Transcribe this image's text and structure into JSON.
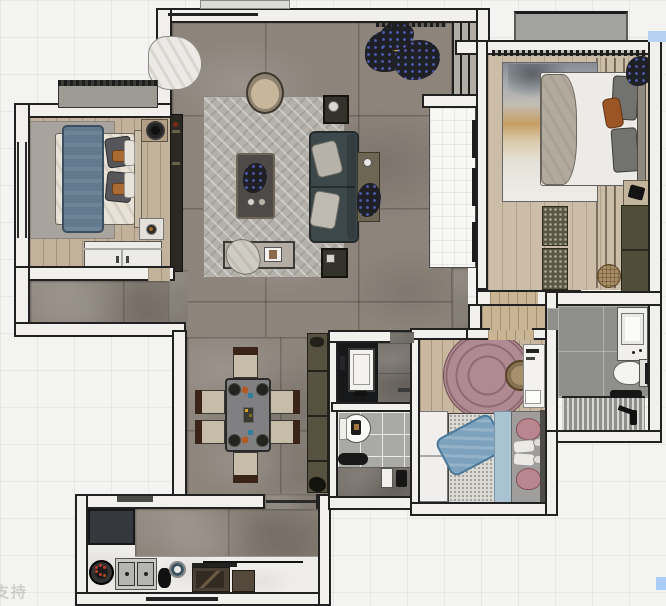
{
  "scene": {
    "type": "apartment-floor-plan-top-down-render",
    "style": "3d-rendered furnished floor plan on light grid background"
  },
  "watermarks": {
    "bottom_left_text": "支持",
    "top_right_swatch_color": "#b5d2f2",
    "bottom_right_swatch_color": "#a9cdf4"
  },
  "palette": {
    "background_grid": "#f3f3f2",
    "wall_fill": "#f1f0ed",
    "wall_outline": "#212121",
    "living_floor_marble": "#8d857c",
    "bedroom_wood": "#c3b29b",
    "master_wood": "#ccbda8",
    "kid_wood": "#c9b79f",
    "rug_grey_herringbone": "#b4b1ab",
    "rug_pink": "#b08a92",
    "sofa_teal": "#3d484b",
    "bed_blue_blanket": "#62798e",
    "kid_bed_blue": "#7ca2bd",
    "accent_orange": "#a96a33",
    "bath_tile": "#8f8f8c",
    "counter_white_marble": "#efedea",
    "cabinet_olive": "#514d3b",
    "cabinet_brown": "#4a3f33"
  },
  "rooms": [
    {
      "id": "living-room",
      "furniture": [
        "area-rug-herringbone",
        "round-armchair",
        "coffee-table-with-plant",
        "sofa",
        "side-table-with-plant",
        "end-table-top",
        "end-table-bottom",
        "bench-with-clothes",
        "large-plant",
        "curtain",
        "tv-cabinet",
        "window-units"
      ]
    },
    {
      "id": "bedroom-left",
      "furniture": [
        "grey-rug",
        "double-bed-blue-blanket",
        "nightstand-with-lamp",
        "nightstand-with-tray",
        "white-wardrobe",
        "top-closet"
      ]
    },
    {
      "id": "master-bedroom",
      "furniture": [
        "landscape-art-rug",
        "double-bed-white-duvet",
        "orange-cushion",
        "foot-bench",
        "olive-wardrobe",
        "round-pouf",
        "nightstand-with-camera",
        "corner-plant",
        "balcony-ac-unit"
      ]
    },
    {
      "id": "dining-area",
      "furniture": [
        "dining-table-with-placesettings",
        "six-chairs",
        "tall-olive-cabinet"
      ]
    },
    {
      "id": "kid-bedroom",
      "furniture": [
        "round-pink-rug",
        "round-pouf",
        "white-desk",
        "single-bed-blue-blanket",
        "pink-pillows",
        "white-wardrobe"
      ]
    },
    {
      "id": "guest-vanity",
      "furniture": [
        "black-counter-with-sink"
      ]
    },
    {
      "id": "guest-bathroom",
      "furniture": [
        "round-mirror-sink",
        "toilet",
        "shower-fixture"
      ]
    },
    {
      "id": "master-bathroom",
      "furniture": [
        "vanity-sink",
        "toilet",
        "shower-striped-floor",
        "shower-fixture"
      ]
    },
    {
      "id": "kitchen",
      "furniture": [
        "fridge",
        "l-shaped-white-counter",
        "gas-burner",
        "double-sink",
        "round-hob",
        "range-hood",
        "brown-cabinets",
        "entry-door-line"
      ]
    },
    {
      "id": "lightwell-shaft",
      "furniture": [
        "window-mullions"
      ]
    },
    {
      "id": "hallway-node",
      "furniture": []
    }
  ]
}
